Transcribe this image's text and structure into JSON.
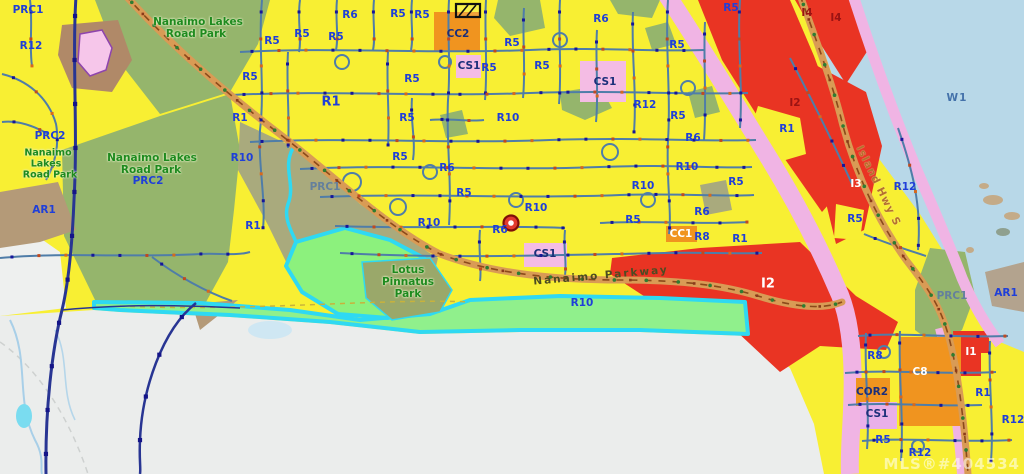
{
  "watermark": "MLS®#404534",
  "marker": {
    "x": 511,
    "y": 223,
    "name": "property-location-marker"
  },
  "palette": {
    "residential_yellow": "#f8ef33",
    "industrial_red": "#e93423",
    "commercial_orange": "#f0941f",
    "cs1_pink": "#f4bce4",
    "corridor_pink": "#f0b4e4",
    "park_green": "#95b56c",
    "marsh_green": "#8cf17d",
    "r10_band_green": "#90f08c",
    "water_blue": "#b8d8e8",
    "cyan_shoreline": "#2fd9f2",
    "unzoned_grey": "#ebedec",
    "zone_label_blue": "#1f3fd9",
    "park_label_green": "#1e8a1e",
    "road_orange": "#d99b55",
    "navy_road": "#283593"
  },
  "labels": [
    {
      "t": "PRC1",
      "x": 28,
      "y": 10,
      "k": "b"
    },
    {
      "t": "R12",
      "x": 31,
      "y": 46,
      "k": "b"
    },
    {
      "t": "PRC2",
      "x": 50,
      "y": 136,
      "k": "b"
    },
    {
      "t": "Nanaimo",
      "x": 48,
      "y": 153,
      "k": "g",
      "s": 9.5
    },
    {
      "t": "Lakes",
      "x": 46,
      "y": 164,
      "k": "g",
      "s": 9.5
    },
    {
      "t": "Road Park",
      "x": 50,
      "y": 175,
      "k": "g",
      "s": 9.5
    },
    {
      "t": "Nanaimo Lakes",
      "x": 198,
      "y": 22,
      "k": "g"
    },
    {
      "t": "Road Park",
      "x": 196,
      "y": 34,
      "k": "g"
    },
    {
      "t": "Nanaimo Lakes",
      "x": 152,
      "y": 158,
      "k": "g"
    },
    {
      "t": "Road Park",
      "x": 151,
      "y": 170,
      "k": "g"
    },
    {
      "t": "PRC2",
      "x": 148,
      "y": 181,
      "k": "b"
    },
    {
      "t": "AR1",
      "x": 44,
      "y": 210,
      "k": "b"
    },
    {
      "t": "R1",
      "x": 253,
      "y": 226,
      "k": "b"
    },
    {
      "t": "R10",
      "x": 242,
      "y": 158,
      "k": "b"
    },
    {
      "t": "R1",
      "x": 240,
      "y": 118,
      "k": "b"
    },
    {
      "t": "R5",
      "x": 250,
      "y": 77,
      "k": "b"
    },
    {
      "t": "R5",
      "x": 272,
      "y": 41,
      "k": "b"
    },
    {
      "t": "R5",
      "x": 302,
      "y": 34,
      "k": "b"
    },
    {
      "t": "R5",
      "x": 336,
      "y": 37,
      "k": "b"
    },
    {
      "t": "R6",
      "x": 350,
      "y": 15,
      "k": "b"
    },
    {
      "t": "R5",
      "x": 398,
      "y": 14,
      "k": "b"
    },
    {
      "t": "R5",
      "x": 422,
      "y": 15,
      "k": "b"
    },
    {
      "t": "CC2",
      "x": 458,
      "y": 34,
      "k": "n"
    },
    {
      "t": "CS1",
      "x": 469,
      "y": 66,
      "k": "n"
    },
    {
      "t": "R5",
      "x": 489,
      "y": 68,
      "k": "b"
    },
    {
      "t": "R5",
      "x": 412,
      "y": 79,
      "k": "b"
    },
    {
      "t": "R1",
      "x": 331,
      "y": 102,
      "k": "b",
      "s": 13
    },
    {
      "t": "R5",
      "x": 407,
      "y": 118,
      "k": "b"
    },
    {
      "t": "R10",
      "x": 508,
      "y": 118,
      "k": "b"
    },
    {
      "t": "R5",
      "x": 512,
      "y": 43,
      "k": "b"
    },
    {
      "t": "R5",
      "x": 542,
      "y": 66,
      "k": "b"
    },
    {
      "t": "R6",
      "x": 601,
      "y": 19,
      "k": "b"
    },
    {
      "t": "R5",
      "x": 731,
      "y": 8,
      "k": "b"
    },
    {
      "t": "CS1",
      "x": 605,
      "y": 82,
      "k": "n"
    },
    {
      "t": "R12",
      "x": 645,
      "y": 105,
      "k": "b"
    },
    {
      "t": "R5",
      "x": 678,
      "y": 116,
      "k": "b"
    },
    {
      "t": "R5",
      "x": 677,
      "y": 45,
      "k": "b"
    },
    {
      "t": "R1",
      "x": 787,
      "y": 129,
      "k": "b"
    },
    {
      "t": "R6",
      "x": 693,
      "y": 138,
      "k": "b"
    },
    {
      "t": "R10",
      "x": 687,
      "y": 167,
      "k": "b"
    },
    {
      "t": "R5",
      "x": 736,
      "y": 182,
      "k": "b"
    },
    {
      "t": "R10",
      "x": 643,
      "y": 186,
      "k": "b"
    },
    {
      "t": "R6",
      "x": 702,
      "y": 212,
      "k": "b"
    },
    {
      "t": "R5",
      "x": 633,
      "y": 220,
      "k": "b"
    },
    {
      "t": "R5",
      "x": 400,
      "y": 157,
      "k": "b"
    },
    {
      "t": "R6",
      "x": 447,
      "y": 168,
      "k": "b"
    },
    {
      "t": "R5",
      "x": 464,
      "y": 193,
      "k": "b"
    },
    {
      "t": "R10",
      "x": 536,
      "y": 208,
      "k": "b"
    },
    {
      "t": "R10",
      "x": 429,
      "y": 223,
      "k": "b"
    },
    {
      "t": "R6",
      "x": 500,
      "y": 230,
      "k": "b"
    },
    {
      "t": "PRC1",
      "x": 325,
      "y": 187,
      "k": "sl"
    },
    {
      "t": "CS1",
      "x": 545,
      "y": 254,
      "k": "n"
    },
    {
      "t": "CC1",
      "x": 681,
      "y": 234,
      "k": "w"
    },
    {
      "t": "R8",
      "x": 702,
      "y": 237,
      "k": "b"
    },
    {
      "t": "R1",
      "x": 740,
      "y": 239,
      "k": "b"
    },
    {
      "t": "I2",
      "x": 768,
      "y": 284,
      "k": "w",
      "s": 13
    },
    {
      "t": "I2",
      "x": 795,
      "y": 103,
      "k": "dr"
    },
    {
      "t": "I4",
      "x": 807,
      "y": 13,
      "k": "dr"
    },
    {
      "t": "I4",
      "x": 836,
      "y": 18,
      "k": "dr"
    },
    {
      "t": "W1",
      "x": 957,
      "y": 98,
      "k": "wt"
    },
    {
      "t": "I3",
      "x": 856,
      "y": 184,
      "k": "w"
    },
    {
      "t": "R12",
      "x": 905,
      "y": 187,
      "k": "b"
    },
    {
      "t": "R5",
      "x": 855,
      "y": 219,
      "k": "b"
    },
    {
      "t": "Island Hwy S",
      "x": 878,
      "y": 186,
      "k": "rd",
      "r": 64
    },
    {
      "t": "PRC1",
      "x": 952,
      "y": 296,
      "k": "sl"
    },
    {
      "t": "AR1",
      "x": 1006,
      "y": 293,
      "k": "b"
    },
    {
      "t": "Nanaimo Parkway",
      "x": 601,
      "y": 276,
      "k": "pk",
      "r": -5
    },
    {
      "t": "Lotus",
      "x": 408,
      "y": 270,
      "k": "g"
    },
    {
      "t": "Pinnatus",
      "x": 408,
      "y": 282,
      "k": "g"
    },
    {
      "t": "Park",
      "x": 408,
      "y": 294,
      "k": "g"
    },
    {
      "t": "R10",
      "x": 582,
      "y": 303,
      "k": "b"
    },
    {
      "t": "R8",
      "x": 875,
      "y": 356,
      "k": "b"
    },
    {
      "t": "C8",
      "x": 920,
      "y": 372,
      "k": "w"
    },
    {
      "t": "COR2",
      "x": 872,
      "y": 392,
      "k": "n"
    },
    {
      "t": "I1",
      "x": 971,
      "y": 352,
      "k": "w"
    },
    {
      "t": "R1",
      "x": 983,
      "y": 393,
      "k": "b"
    },
    {
      "t": "R12",
      "x": 1013,
      "y": 420,
      "k": "b"
    },
    {
      "t": "CS1",
      "x": 877,
      "y": 414,
      "k": "n"
    },
    {
      "t": "R5",
      "x": 883,
      "y": 440,
      "k": "b"
    },
    {
      "t": "R12",
      "x": 920,
      "y": 453,
      "k": "b"
    }
  ]
}
